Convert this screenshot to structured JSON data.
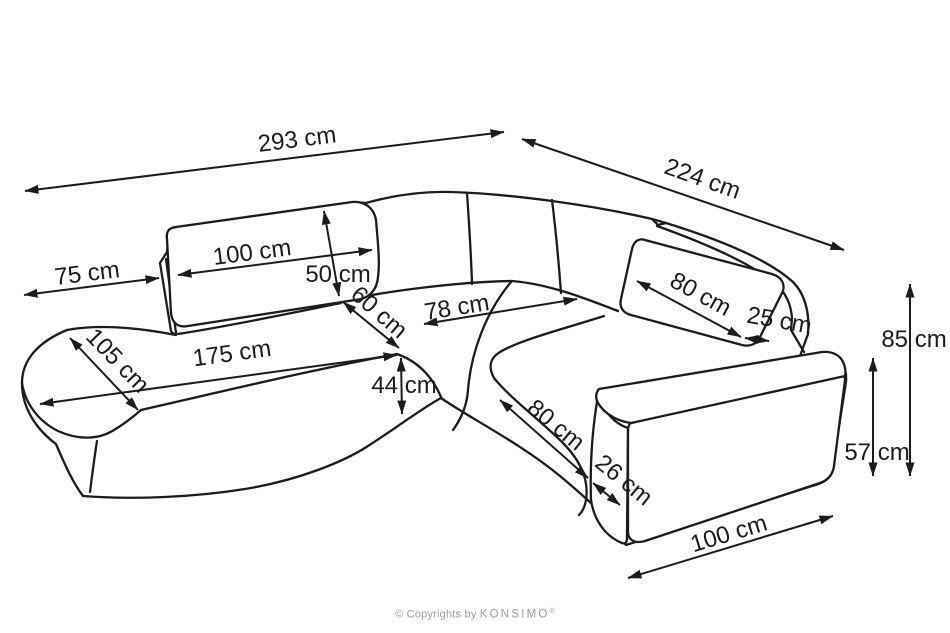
{
  "diagram": {
    "description": "Corner sofa technical dimension drawing",
    "colors": {
      "line": "#1c1c1c",
      "background": "#ffffff",
      "muted_text": "#9b9b9b"
    },
    "dimensions": [
      {
        "name": "dim-overall-width-293",
        "label": "293 cm",
        "line": [
          25,
          191,
          504,
          132
        ],
        "text_pos": [
          298,
          147
        ],
        "text_rotation": -7.2
      },
      {
        "name": "dim-overall-depth-224",
        "label": "224 cm",
        "line": [
          522,
          139,
          844,
          250
        ],
        "text_pos": [
          700,
          186
        ],
        "text_rotation": 19.5
      },
      {
        "name": "dim-chaise-overhang-75",
        "label": "75 cm",
        "line": [
          24,
          295,
          159,
          278
        ],
        "text_pos": [
          88,
          281
        ],
        "text_rotation": -7
      },
      {
        "name": "dim-back-cushion-100",
        "label": "100 cm",
        "line": [
          178,
          275,
          372,
          250
        ],
        "text_pos": [
          253,
          260
        ],
        "text_rotation": -7.3
      },
      {
        "name": "dim-back-cushion-height-50",
        "label": "50 cm",
        "line": [
          324,
          211,
          339,
          296
        ],
        "text_pos": [
          338,
          282
        ],
        "text_rotation": 0
      },
      {
        "name": "dim-seat-depth-60",
        "label": "60 cm",
        "line": [
          343,
          302,
          399,
          348
        ],
        "text_pos": [
          374,
          318
        ],
        "text_rotation": 41
      },
      {
        "name": "dim-corner-seat-78",
        "label": "78 cm",
        "line": [
          424,
          324,
          577,
          299
        ],
        "text_pos": [
          458,
          315
        ],
        "text_rotation": -9
      },
      {
        "name": "dim-right-back-cushion-80",
        "label": "80 cm",
        "line": [
          637,
          281,
          741,
          337
        ],
        "text_pos": [
          697,
          301
        ],
        "text_rotation": 28.5
      },
      {
        "name": "dim-back-gap-25",
        "label": "25 cm",
        "line": [
          745,
          338,
          769,
          341
        ],
        "text_pos": [
          778,
          328
        ],
        "text_rotation": 10
      },
      {
        "name": "dim-total-height-85",
        "label": "85 cm",
        "line": [
          910,
          284,
          910,
          476
        ],
        "text_pos": [
          914,
          347
        ],
        "text_rotation": 0
      },
      {
        "name": "dim-armrest-height-57",
        "label": "57 cm",
        "line": [
          873,
          358,
          873,
          476
        ],
        "text_pos": [
          877,
          460
        ],
        "text_rotation": 0
      },
      {
        "name": "dim-chaise-width-105",
        "label": "105 cm",
        "line": [
          70,
          338,
          138,
          410
        ],
        "text_pos": [
          112,
          366
        ],
        "text_rotation": 46
      },
      {
        "name": "dim-seat-length-175",
        "label": "175 cm",
        "line": [
          40,
          404,
          397,
          355
        ],
        "text_pos": [
          233,
          361
        ],
        "text_rotation": -7.8
      },
      {
        "name": "dim-seat-height-44",
        "label": "44 cm",
        "line": [
          401,
          358,
          402,
          414
        ],
        "text_pos": [
          404,
          393
        ],
        "text_rotation": 0
      },
      {
        "name": "dim-right-seat-depth-80",
        "label": "80 cm",
        "line": [
          500,
          400,
          588,
          478
        ],
        "text_pos": [
          551,
          431
        ],
        "text_rotation": 39
      },
      {
        "name": "dim-armrest-width-26",
        "label": "26 cm",
        "line": [
          593,
          483,
          620,
          505
        ],
        "text_pos": [
          619,
          486
        ],
        "text_rotation": 39
      },
      {
        "name": "dim-right-section-100",
        "label": "100 cm",
        "line": [
          628,
          578,
          833,
          516
        ],
        "text_pos": [
          731,
          541
        ],
        "text_rotation": -16.8
      }
    ]
  },
  "footer": {
    "copyright_prefix": "© Copyrights by",
    "brand": "KONSIMO",
    "registered_mark": "®"
  }
}
